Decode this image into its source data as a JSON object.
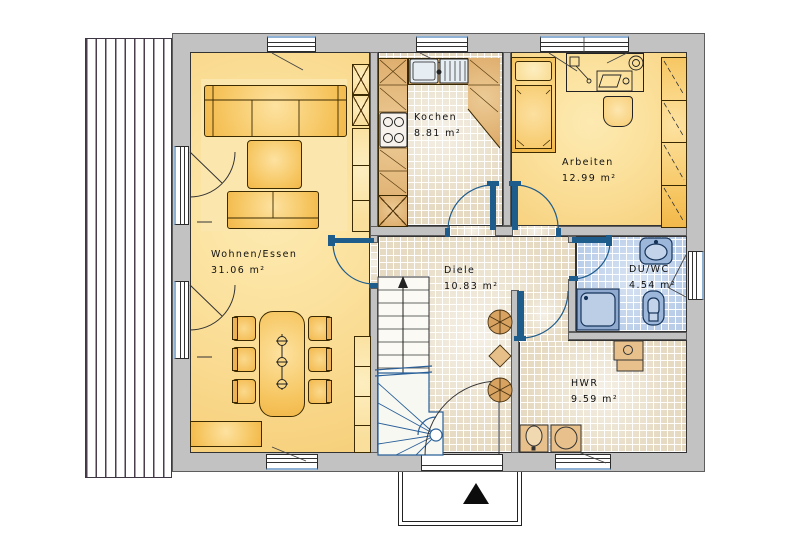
{
  "plan_title": "Erdgeschoss Grundriss",
  "rooms": [
    {
      "id": "wohnen-essen",
      "label": "Wohnen/Essen",
      "area": "31.06 m²"
    },
    {
      "id": "kochen",
      "label": "Kochen",
      "area": "8.81 m²"
    },
    {
      "id": "arbeiten",
      "label": "Arbeiten",
      "area": "12.99 m²"
    },
    {
      "id": "diele",
      "label": "Diele",
      "area": "10.83 m²"
    },
    {
      "id": "du-wc",
      "label": "DU/WC",
      "area": "4.54 m²"
    },
    {
      "id": "hwr",
      "label": "HWR",
      "area": "9.59 m²"
    }
  ],
  "icons": {
    "entrance-arrow": "north/entrance triangle",
    "stair-up-arrow": "arrow up",
    "plant": "circle with radial spokes"
  },
  "colors": {
    "wall_gray": "#c2c2c2",
    "room_yellow": "#fbe09b",
    "furniture_orange": "#f4bd55",
    "counter_tan": "#e0b172",
    "tile_beige": "#e6dac2",
    "tile_blue": "#b9cde9",
    "fixture_blue": "#9db7da",
    "door_blue": "#1e5c8c",
    "deck_stripe": "#4a3e4c"
  }
}
